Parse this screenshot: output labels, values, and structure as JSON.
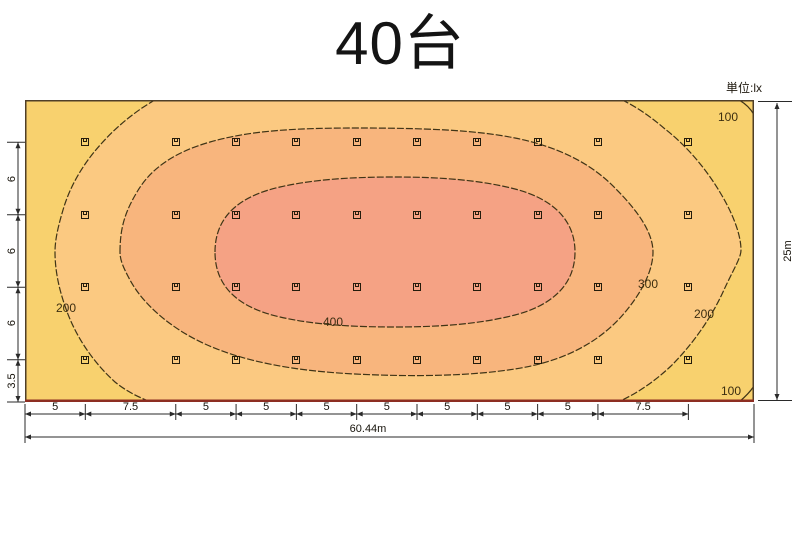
{
  "title": "40台",
  "unit_label": "単位:lx",
  "chart_data": {
    "type": "heatmap",
    "subtype": "illuminance-contour-plot",
    "title": "40台",
    "unit": "lx",
    "field": {
      "width_m": 60.44,
      "height_m": 25
    },
    "contour_levels_lx": [
      100,
      200,
      300,
      400
    ],
    "contour_labels": [
      {
        "text": "100",
        "x": 728,
        "y": 117
      },
      {
        "text": "200",
        "x": 66,
        "y": 308
      },
      {
        "text": "400",
        "x": 333,
        "y": 322
      },
      {
        "text": "300",
        "x": 648,
        "y": 284
      },
      {
        "text": "200",
        "x": 704,
        "y": 314
      },
      {
        "text": "100",
        "x": 731,
        "y": 391
      }
    ],
    "band_colors": {
      "lt_200": "#F8D16E",
      "b200_300": "#FBC981",
      "b300_400": "#F8B57D",
      "gt_400": "#F5A284"
    },
    "fixtures": {
      "count": 40,
      "col_offsets_m": [
        5,
        12.5,
        17.5,
        22.5,
        27.5,
        32.5,
        37.5,
        42.5,
        47.5,
        55
      ],
      "row_offsets_m": [
        3.5,
        9.5,
        15.5,
        21.5
      ]
    }
  },
  "dimensions": {
    "bottom": {
      "segments": [
        "5",
        "7.5",
        "5",
        "5",
        "5",
        "5",
        "5",
        "5",
        "5",
        "7.5"
      ],
      "total": "60.44m"
    },
    "left": {
      "segments": [
        "6",
        "6",
        "6",
        "3.5"
      ]
    },
    "right": {
      "total": "25m"
    }
  }
}
